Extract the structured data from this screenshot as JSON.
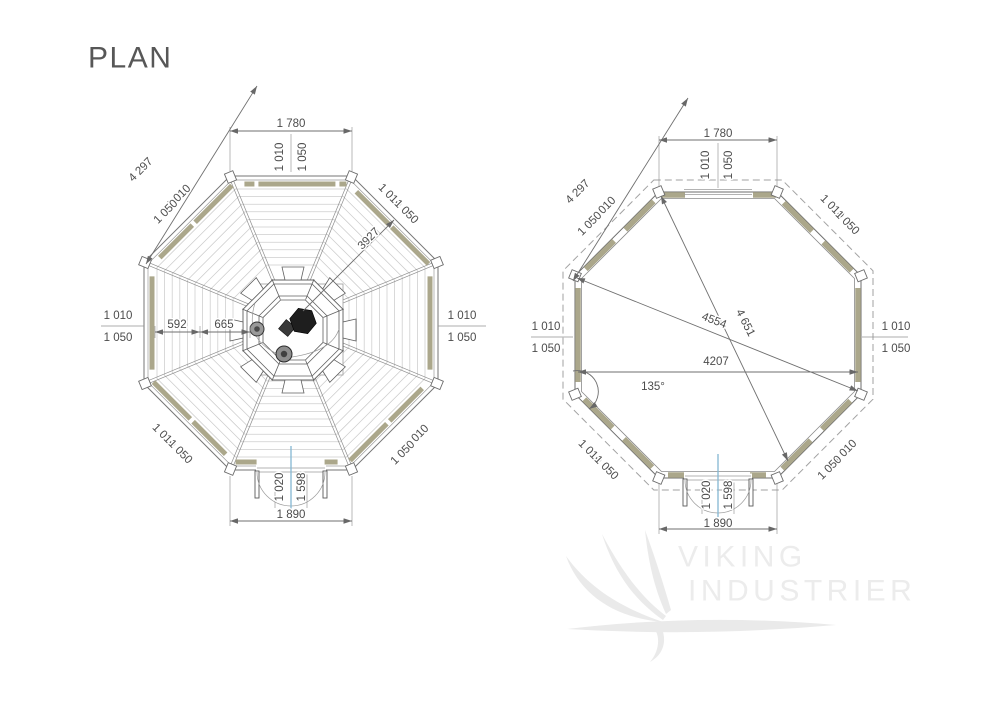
{
  "page": {
    "title": "PLAN"
  },
  "watermark": {
    "word1": "VIKING",
    "word2": "INDUSTRIER"
  },
  "colors": {
    "wall_log": "#aba78b",
    "door_axis": "#84b7d3",
    "chimney": "#1e1e1e",
    "dim_line": "#6f6f6f",
    "watermark": "#ececec"
  },
  "roof_plan": {
    "top_width": "1 780",
    "top_inner": "1 010",
    "top_outer": "1 050",
    "overall_diag": "4 297",
    "corner_nw_inner": "1 010",
    "corner_nw_outer": "1 050",
    "corner_ne_inner": "1 010",
    "corner_ne_outer": "1 050",
    "side_w_inner": "1 010",
    "side_w_outer": "1 050",
    "side_e_inner": "1 010",
    "side_e_outer": "1 050",
    "corner_sw_inner": "1 010",
    "corner_sw_outer": "1 050",
    "corner_se_inner": "1 010",
    "corner_se_outer": "1 050",
    "hub_left": "592",
    "hub_right": "665",
    "slope_diag": "3927",
    "door_width": "1 020",
    "door_height": "1 598",
    "bottom_width": "1 890"
  },
  "floor_plan": {
    "top_width": "1 780",
    "top_inner": "1 010",
    "top_outer": "1 050",
    "overall_diag": "4 297",
    "corner_nw_inner": "1 010",
    "corner_nw_outer": "1 050",
    "corner_ne_inner": "1 010",
    "corner_ne_outer": "1 050",
    "side_w_inner": "1 010",
    "side_w_outer": "1 050",
    "side_e_inner": "1 010",
    "side_e_outer": "1 050",
    "corner_sw_inner": "1 010",
    "corner_sw_outer": "1 050",
    "corner_se_inner": "1 010",
    "corner_se_outer": "1 050",
    "diag_a": "4554",
    "diag_b": "4 651",
    "inner_width": "4207",
    "corner_angle": "135°",
    "door_width": "1 020",
    "door_height": "1 598",
    "bottom_width": "1 890"
  }
}
